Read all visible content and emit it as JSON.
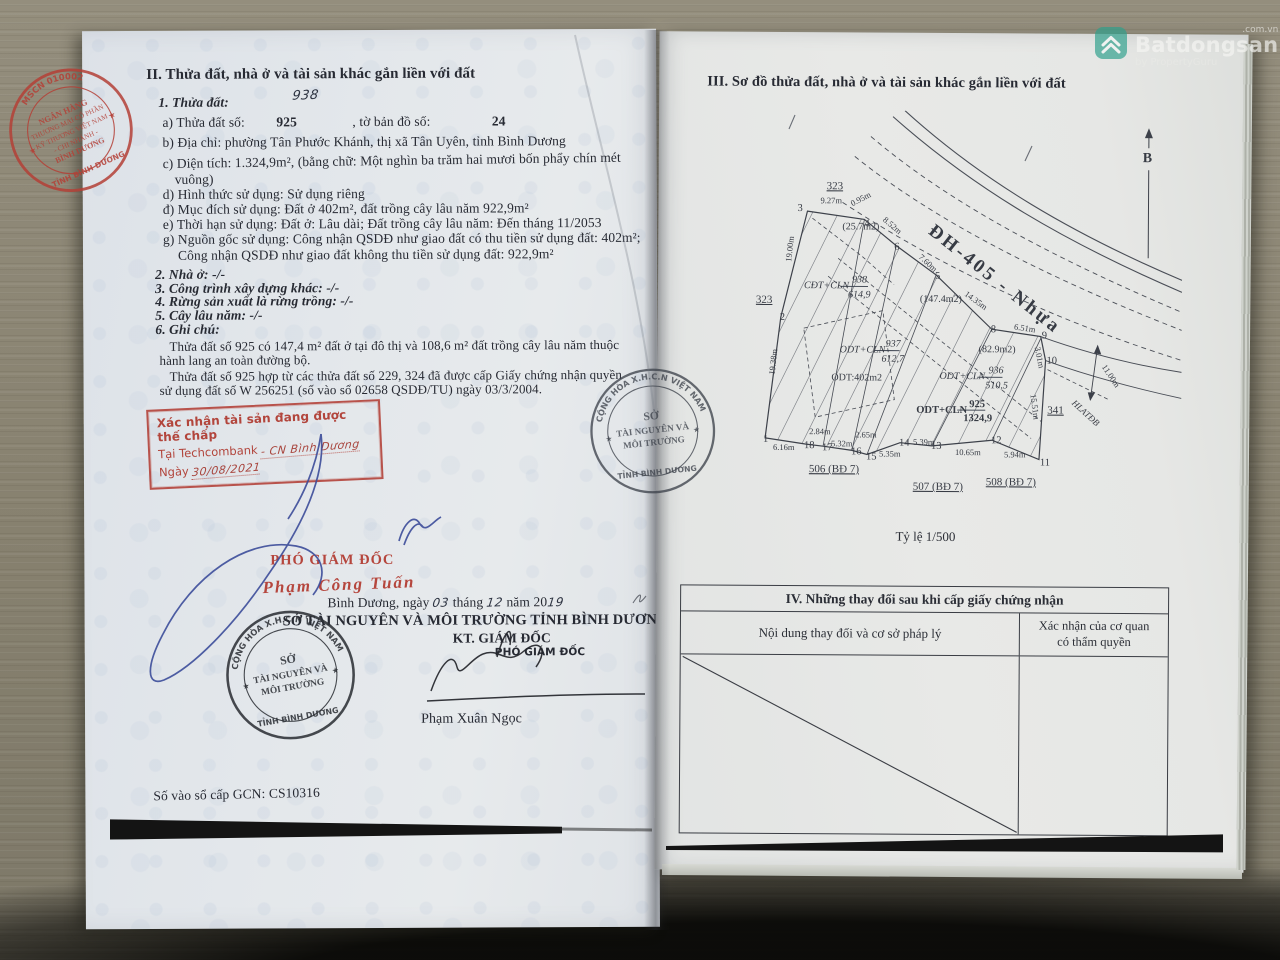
{
  "watermark": {
    "domain": ".com.vn",
    "brand": "Batdongsan",
    "tagline": "by PropertyGuru"
  },
  "left_page": {
    "title2": "II. Thửa đất, nhà ở và tài sản khác gắn liền với đất",
    "sec1": "1. Thửa đất:",
    "plot_annotation": "938",
    "a_parts": [
      "a) Thửa đất số:",
      "925",
      ", tờ bản đồ số:",
      "24"
    ],
    "b": "b) Địa chỉ:  phường Tân Phước Khánh, thị xã Tân Uyên, tỉnh Bình Dương",
    "c1": "c) Diện tích:        1.324,9m², (bằng chữ: Một nghìn ba trăm hai mươi bốn phẩy chín mét",
    "c2": "vuông)",
    "d": "d) Hình thức sử dụng:   Sử dụng riêng",
    "dd": "đ) Mục đích sử dụng:  Đất ở 402m², đất trồng cây lâu năm 922,9m²",
    "e": "e) Thời hạn sử dụng:  Đất ở: Lâu dài; Đất trồng cây lâu năm: Đến tháng 11/2053",
    "g": "g) Nguồn gốc sử dụng: Công nhận QSDĐ như giao đất có thu tiền sử dụng đất: 402m²;",
    "g2": "Công nhận QSDĐ như giao đất không thu tiền sử dụng đất: 922,9m²",
    "sec2": "2. Nhà ở:  -/-",
    "sec3": "3. Công trình xây dựng khác: -/-",
    "sec4": "4. Rừng sản xuất là rừng trồng: -/-",
    "sec5": "5. Cây lâu năm:  -/-",
    "sec6": "6. Ghi chú:",
    "note1a": "Thửa đất số 925 có 147,4 m² đất ở tại đô thị và 108,6 m² đất trồng cây lâu năm thuộc",
    "note1b": "hành lang an toàn đường bộ.",
    "note2a": "Thửa đất số 925 hợp từ các thửa đất số 229, 324 đã được cấp Giấy chứng nhận quyền",
    "note2b": "sử dụng đất số W 256251 (số vào sổ 02658 QSDĐ/TU) ngày 03/3/2004.",
    "mortgage": {
      "line1": "Xác nhận tài sản đang được thế chấp",
      "line2_label": "Tại Techcombank",
      "line2_hand": "- CN Bình Dương",
      "line3_label": "Ngày",
      "line3_hand": "30/08/2021"
    },
    "sig": {
      "red_title": "PHÓ GIÁM ĐỐC",
      "red_name": "Phạm Công Tuấn",
      "date_parts": [
        "Bình Dương, ngày ",
        "03",
        " tháng ",
        "12",
        " năm 20",
        "19"
      ],
      "dept": "SỞ TÀI NGUYÊN VÀ MÔI TRƯỜNG TỈNH BÌNH DƯƠNG",
      "kt": "KT. GIÁM ĐỐC",
      "deputy": "PHÓ GIÁM ĐỐC",
      "name": "Phạm Xuân Ngọc"
    },
    "reg_number": "Số vào sổ cấp GCN: CS10316"
  },
  "bank_seal": {
    "ring_top": "MSCN 010002",
    "center": [
      "NGÂN HÀNG",
      "THƯƠNG MẠI CỔ PHẦN",
      "KỸ THƯƠNG VIỆT NAM",
      "- CHI NHÁNH -",
      "BÌNH DƯƠNG"
    ],
    "ring_bottom": "TỈNH BÌNH DƯƠNG",
    "star": "★"
  },
  "dept_seal": {
    "ring_top": "CỘNG HÒA X.H.C.N VIỆT NAM",
    "center": [
      "SỞ",
      "TÀI NGUYÊN VÀ",
      "MÔI TRƯỜNG"
    ],
    "ring_bottom": "TỈNH BÌNH DƯƠNG",
    "star": "★"
  },
  "right_page": {
    "title3": "III. Sơ đồ thửa đất, nhà ở và tài sản khác gắn liền với đất",
    "scale": "Tỷ lệ 1/500",
    "table4": {
      "title": "IV. Những thay đổi sau khi cấp giấy chứng nhận",
      "col1": "Nội dung thay đổi và cơ sở pháp lý",
      "col2a": "Xác nhận của cơ quan",
      "col2b": "có thẩm quyền"
    },
    "map": {
      "labels": [
        {
          "t": "3",
          "x": 55,
          "y": 101,
          "c": "pt"
        },
        {
          "t": "4",
          "x": 122,
          "y": 116,
          "c": "pt"
        },
        {
          "t": "6",
          "x": 152,
          "y": 139,
          "c": "pt"
        },
        {
          "t": "5",
          "x": 193,
          "y": 168,
          "c": "pt"
        },
        {
          "t": "8",
          "x": 249,
          "y": 221,
          "c": "pt"
        },
        {
          "t": "9",
          "x": 300,
          "y": 227,
          "c": "pt"
        },
        {
          "t": "10",
          "x": 305,
          "y": 252,
          "c": "pt"
        },
        {
          "t": "11",
          "x": 299,
          "y": 354,
          "c": "pt"
        },
        {
          "t": "12",
          "x": 250,
          "y": 332,
          "c": "pt"
        },
        {
          "t": "13",
          "x": 190,
          "y": 338,
          "c": "pt"
        },
        {
          "t": "14",
          "x": 158,
          "y": 335,
          "c": "pt"
        },
        {
          "t": "15",
          "x": 125,
          "y": 349,
          "c": "pt"
        },
        {
          "t": "16",
          "x": 110,
          "y": 344,
          "c": "pt"
        },
        {
          "t": "17",
          "x": 81,
          "y": 340,
          "c": "pt"
        },
        {
          "t": "18",
          "x": 63,
          "y": 338,
          "c": "pt"
        },
        {
          "t": "1",
          "x": 22,
          "y": 332,
          "c": "pt"
        },
        {
          "t": "2",
          "x": 38,
          "y": 210,
          "c": "pt"
        },
        {
          "t": "9.27m",
          "x": 78,
          "y": 93,
          "c": "dim"
        },
        {
          "t": "0.95m",
          "x": 110,
          "y": 96,
          "r": -28,
          "c": "dim"
        },
        {
          "t": "8.52m",
          "x": 140,
          "y": 110,
          "r": 40,
          "c": "dim"
        },
        {
          "t": "7.60m",
          "x": 176,
          "y": 147,
          "r": 42,
          "c": "dim"
        },
        {
          "t": "14.35m",
          "x": 222,
          "y": 184,
          "r": 36,
          "c": "dim"
        },
        {
          "t": "6.51m",
          "x": 272,
          "y": 218,
          "r": 8,
          "c": "dim"
        },
        {
          "t": "3.01m",
          "x": 293,
          "y": 236,
          "r": 78,
          "c": "dim"
        },
        {
          "t": "15.51m",
          "x": 289,
          "y": 283,
          "r": 82,
          "c": "dim"
        },
        {
          "t": "19.00m",
          "x": 49,
          "y": 152,
          "r": -84,
          "c": "dim"
        },
        {
          "t": "19.38m",
          "x": 33,
          "y": 265,
          "r": -84,
          "c": "dim"
        },
        {
          "t": "6.16m",
          "x": 32,
          "y": 340,
          "c": "dim"
        },
        {
          "t": "2.84m",
          "x": 68,
          "y": 324,
          "c": "dim"
        },
        {
          "t": "5.32m",
          "x": 90,
          "y": 336,
          "c": "dim"
        },
        {
          "t": "2.65m",
          "x": 114,
          "y": 327,
          "c": "dim"
        },
        {
          "t": "5.35m",
          "x": 138,
          "y": 346,
          "c": "dim"
        },
        {
          "t": "5.39m",
          "x": 172,
          "y": 334,
          "c": "dim"
        },
        {
          "t": "10.65m",
          "x": 214,
          "y": 344,
          "c": "dim"
        },
        {
          "t": "5.94m",
          "x": 263,
          "y": 346,
          "c": "dim"
        },
        {
          "t": "11.00m",
          "x": 360,
          "y": 255,
          "r": 56,
          "c": "dim"
        },
        {
          "t": "323",
          "x": 84,
          "y": 79,
          "c": "adj"
        },
        {
          "t": "323",
          "x": 14,
          "y": 193,
          "c": "adj"
        },
        {
          "t": "341",
          "x": 306,
          "y": 302,
          "c": "adj"
        },
        {
          "t": "506 (BĐ 7)",
          "x": 68,
          "y": 362,
          "c": "adj"
        },
        {
          "t": "507 (BĐ 7)",
          "x": 172,
          "y": 379,
          "c": "adj"
        },
        {
          "t": "508 (BĐ 7)",
          "x": 245,
          "y": 374,
          "c": "adj"
        },
        {
          "t": "(25.7m2)",
          "x": 100,
          "y": 119,
          "c": "area"
        },
        {
          "t": "(147.4m2)",
          "x": 178,
          "y": 191,
          "c": "area"
        },
        {
          "t": "(82.9m2)",
          "x": 237,
          "y": 241,
          "c": "area"
        },
        {
          "t": "ODT:402m2",
          "x": 90,
          "y": 270,
          "c": "area"
        },
        {
          "t": "ĐH-405 - Nhựa",
          "x": 185,
          "y": 122,
          "r": 38,
          "c": "road"
        },
        {
          "t": "HLATĐB",
          "x": 330,
          "y": 292,
          "r": 42,
          "c": "small"
        },
        {
          "t": "B",
          "x": 400,
          "y": 50,
          "c": "north"
        },
        {
          "t": "CĐT+CLN",
          "x": 62,
          "y": 178,
          "c": "hand"
        },
        {
          "t": "938",
          "x": 110,
          "y": 172,
          "c": "hand"
        },
        {
          "t": "614,9",
          "x": 106,
          "y": 187,
          "c": "hand"
        },
        {
          "t": "ODT+CLN",
          "x": 98,
          "y": 242,
          "c": "hand"
        },
        {
          "t": "937",
          "x": 144,
          "y": 236,
          "c": "hand"
        },
        {
          "t": "612,7",
          "x": 140,
          "y": 251,
          "c": "hand"
        },
        {
          "t": "ODT+CLN",
          "x": 198,
          "y": 268,
          "c": "hand"
        },
        {
          "t": "936",
          "x": 247,
          "y": 262,
          "c": "hand"
        },
        {
          "t": "510,5",
          "x": 244,
          "y": 277,
          "c": "hand"
        },
        {
          "t": "ODT+CLN",
          "x": 175,
          "y": 302,
          "c": "parcel"
        },
        {
          "t": "925",
          "x": 228,
          "y": 296,
          "c": "parcel"
        },
        {
          "t": "1324,9",
          "x": 222,
          "y": 310,
          "c": "parcel"
        }
      ]
    }
  }
}
